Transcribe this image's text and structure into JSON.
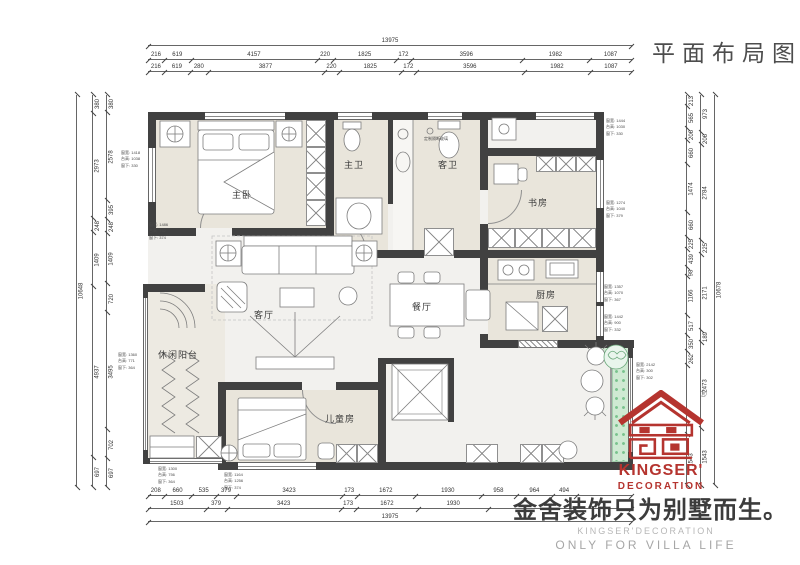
{
  "title": "平面布局图",
  "rooms": {
    "master": "主卧",
    "master_bath": "主卫",
    "guest_bath": "客卫",
    "study": "书房",
    "kitchen": "厨房",
    "dining": "餐厅",
    "living": "客厅",
    "balcony": "休闲阳台",
    "kids": "儿童房"
  },
  "annotations": {
    "glass_note": "定制隔断玻璃",
    "window_notes": [
      [
        "窗宽: 1418",
        "台高: 1038",
        "窗下: 330"
      ],
      [
        "窗宽: 1486",
        "台高: 762",
        "窗下: 374"
      ],
      [
        "窗宽: 1360",
        "台高: 771",
        "窗下: 364"
      ],
      [
        "窗宽: 1300",
        "台高: 756",
        "窗下: 364"
      ],
      [
        "窗宽: 1164",
        "台高: 1256",
        "窗下: 374"
      ],
      [
        "窗宽: 1444",
        "台高: 1030",
        "窗下: 330"
      ],
      [
        "窗宽: 1274",
        "台高: 1040",
        "窗下: 379"
      ],
      [
        "窗宽: 1357",
        "台高: 1070",
        "窗下: 367"
      ],
      [
        "窗宽: 1442",
        "台高: 900",
        "窗下: 332"
      ],
      [
        "窗宽: 2142",
        "台高: 300",
        "窗下: 302"
      ]
    ]
  },
  "dimensions": {
    "top": {
      "total": [
        "13975"
      ],
      "row1": [
        "216",
        "619",
        "4157",
        "220",
        "1825",
        "172",
        "3596",
        "1982",
        "1087"
      ],
      "row2": [
        "216",
        "619",
        "280",
        "3877",
        "220",
        "1825",
        "172",
        "3596",
        "1982",
        "1087"
      ]
    },
    "bottom": {
      "row1": [
        "208",
        "660",
        "535",
        "379",
        "3423",
        "173",
        "1672",
        "1930",
        "958",
        "964",
        "494",
        {
          "w": 2085,
          "t": ""
        }
      ],
      "row2": [
        "1503",
        "379",
        "3423",
        "173",
        "1672",
        "1930",
        {
          "w": 4895,
          "t": ""
        }
      ],
      "total": [
        "13975"
      ]
    },
    "left": {
      "total": [
        "10648"
      ],
      "row1": [
        "380",
        "2973",
        "248",
        "1409",
        "4937",
        "697"
      ],
      "row2": [
        "380",
        "2578",
        "395",
        "248",
        "1409",
        "720",
        "3495",
        "702",
        "697"
      ]
    },
    "right": {
      "row1": [
        "213",
        "565",
        "206",
        "660",
        "1474",
        "660",
        "225",
        "439",
        "98",
        "1166",
        "517",
        "350",
        "262",
        {
          "w": 2473,
          "t": ""
        },
        "1543"
      ],
      "row2": [
        "973",
        "206",
        "2784",
        "225",
        "2171",
        "189",
        "2473",
        "1543"
      ],
      "total": [
        "10678"
      ]
    }
  },
  "branding": {
    "logo_text": "KINGSER'",
    "logo_subtext": "DECORATION",
    "registered": "®",
    "slogan": "金舍装饰只为别墅而生。",
    "slogan_en1": "KINGSER'DECORATION",
    "slogan_en2": "ONLY FOR VILLA LIFE"
  },
  "colors": {
    "brand_red": "#b5342f",
    "wall": "#414141",
    "room_fill": "#e9e5db",
    "floor_fill": "#f2f1ee",
    "green_strip": "#cfe9d2",
    "dim_line": "#666666"
  }
}
